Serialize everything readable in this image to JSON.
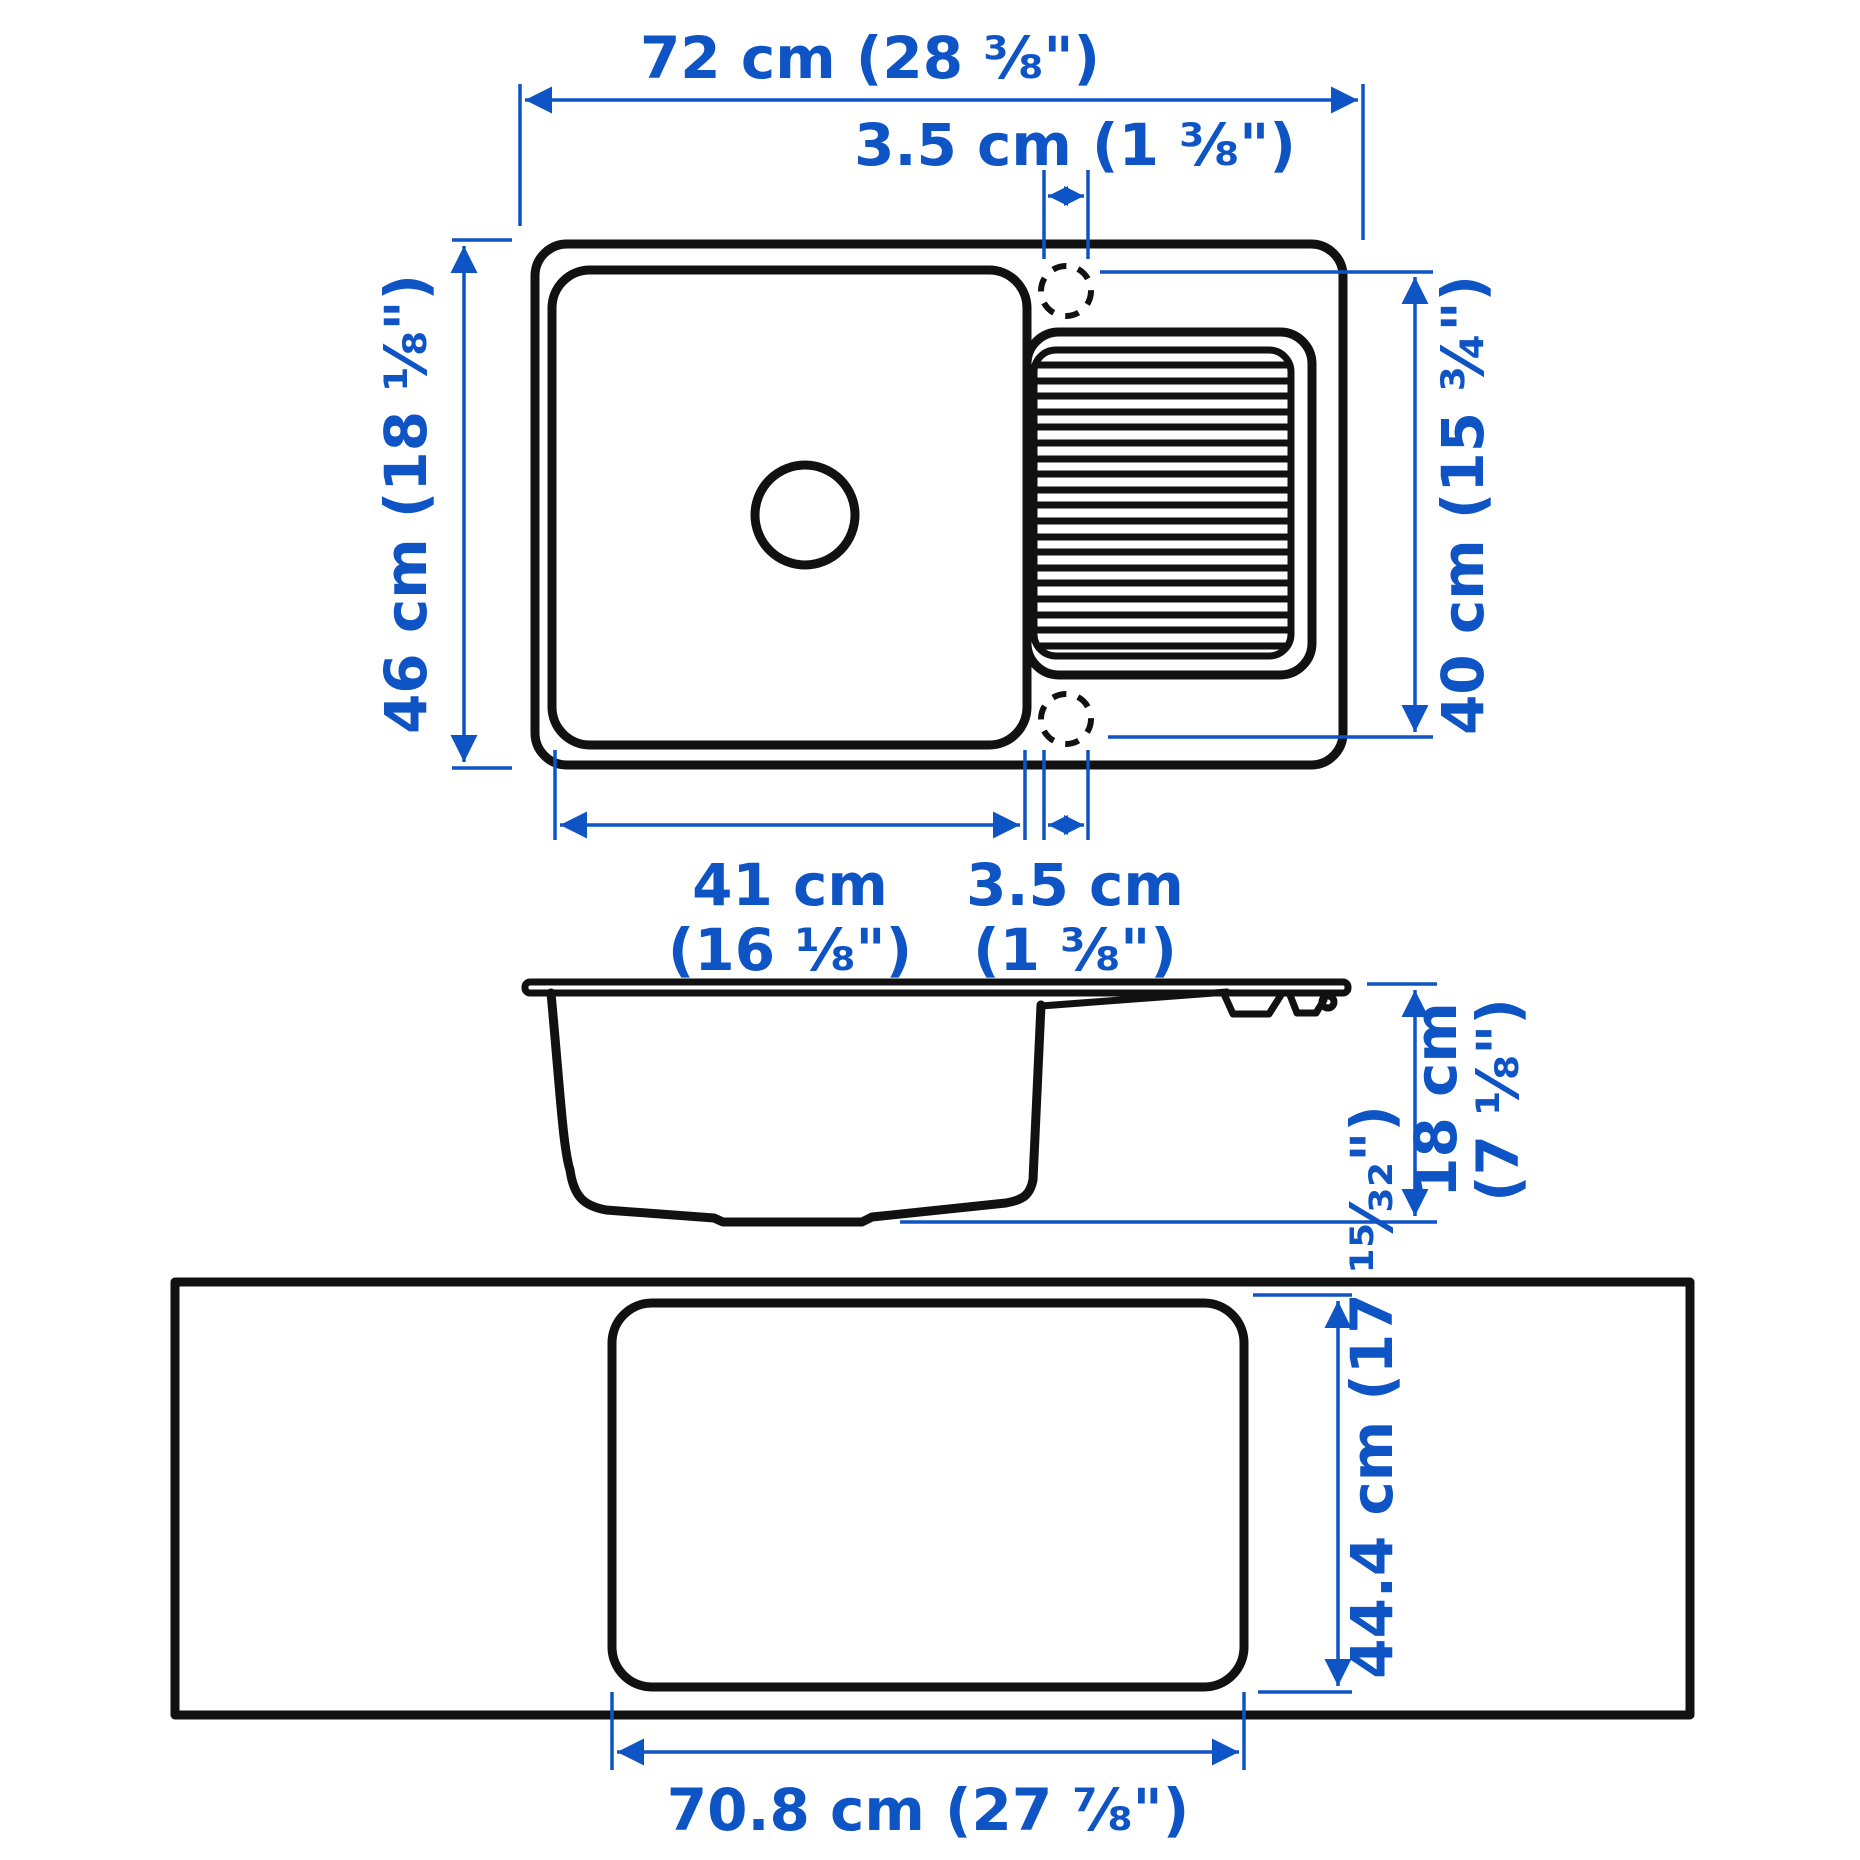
{
  "colors": {
    "dimension_blue": "#0e54c4",
    "outline_black": "#111111",
    "background": "#ffffff"
  },
  "dimensions": {
    "top_view": {
      "overall_width": "72 cm (28 ⅜\")",
      "faucet_offset_top": "3.5 cm (1 ⅜\")",
      "overall_depth": "46 cm (18 ⅛\")",
      "drainboard_depth": "40 cm (15 ¾\")",
      "bowl_width_line1": "41 cm",
      "bowl_width_line2": "(16 ⅛\")",
      "faucet_offset_bottom_line1": "3.5 cm",
      "faucet_offset_bottom_line2": "(1 ⅜\")"
    },
    "side_view": {
      "height_line1": "18 cm",
      "height_line2": "(7 ⅛\")"
    },
    "cutout_view": {
      "cutout_depth": "44.4 cm (17 ¹⁵⁄₃₂\")",
      "cutout_width": "70.8 cm (27 ⅞\")"
    }
  }
}
